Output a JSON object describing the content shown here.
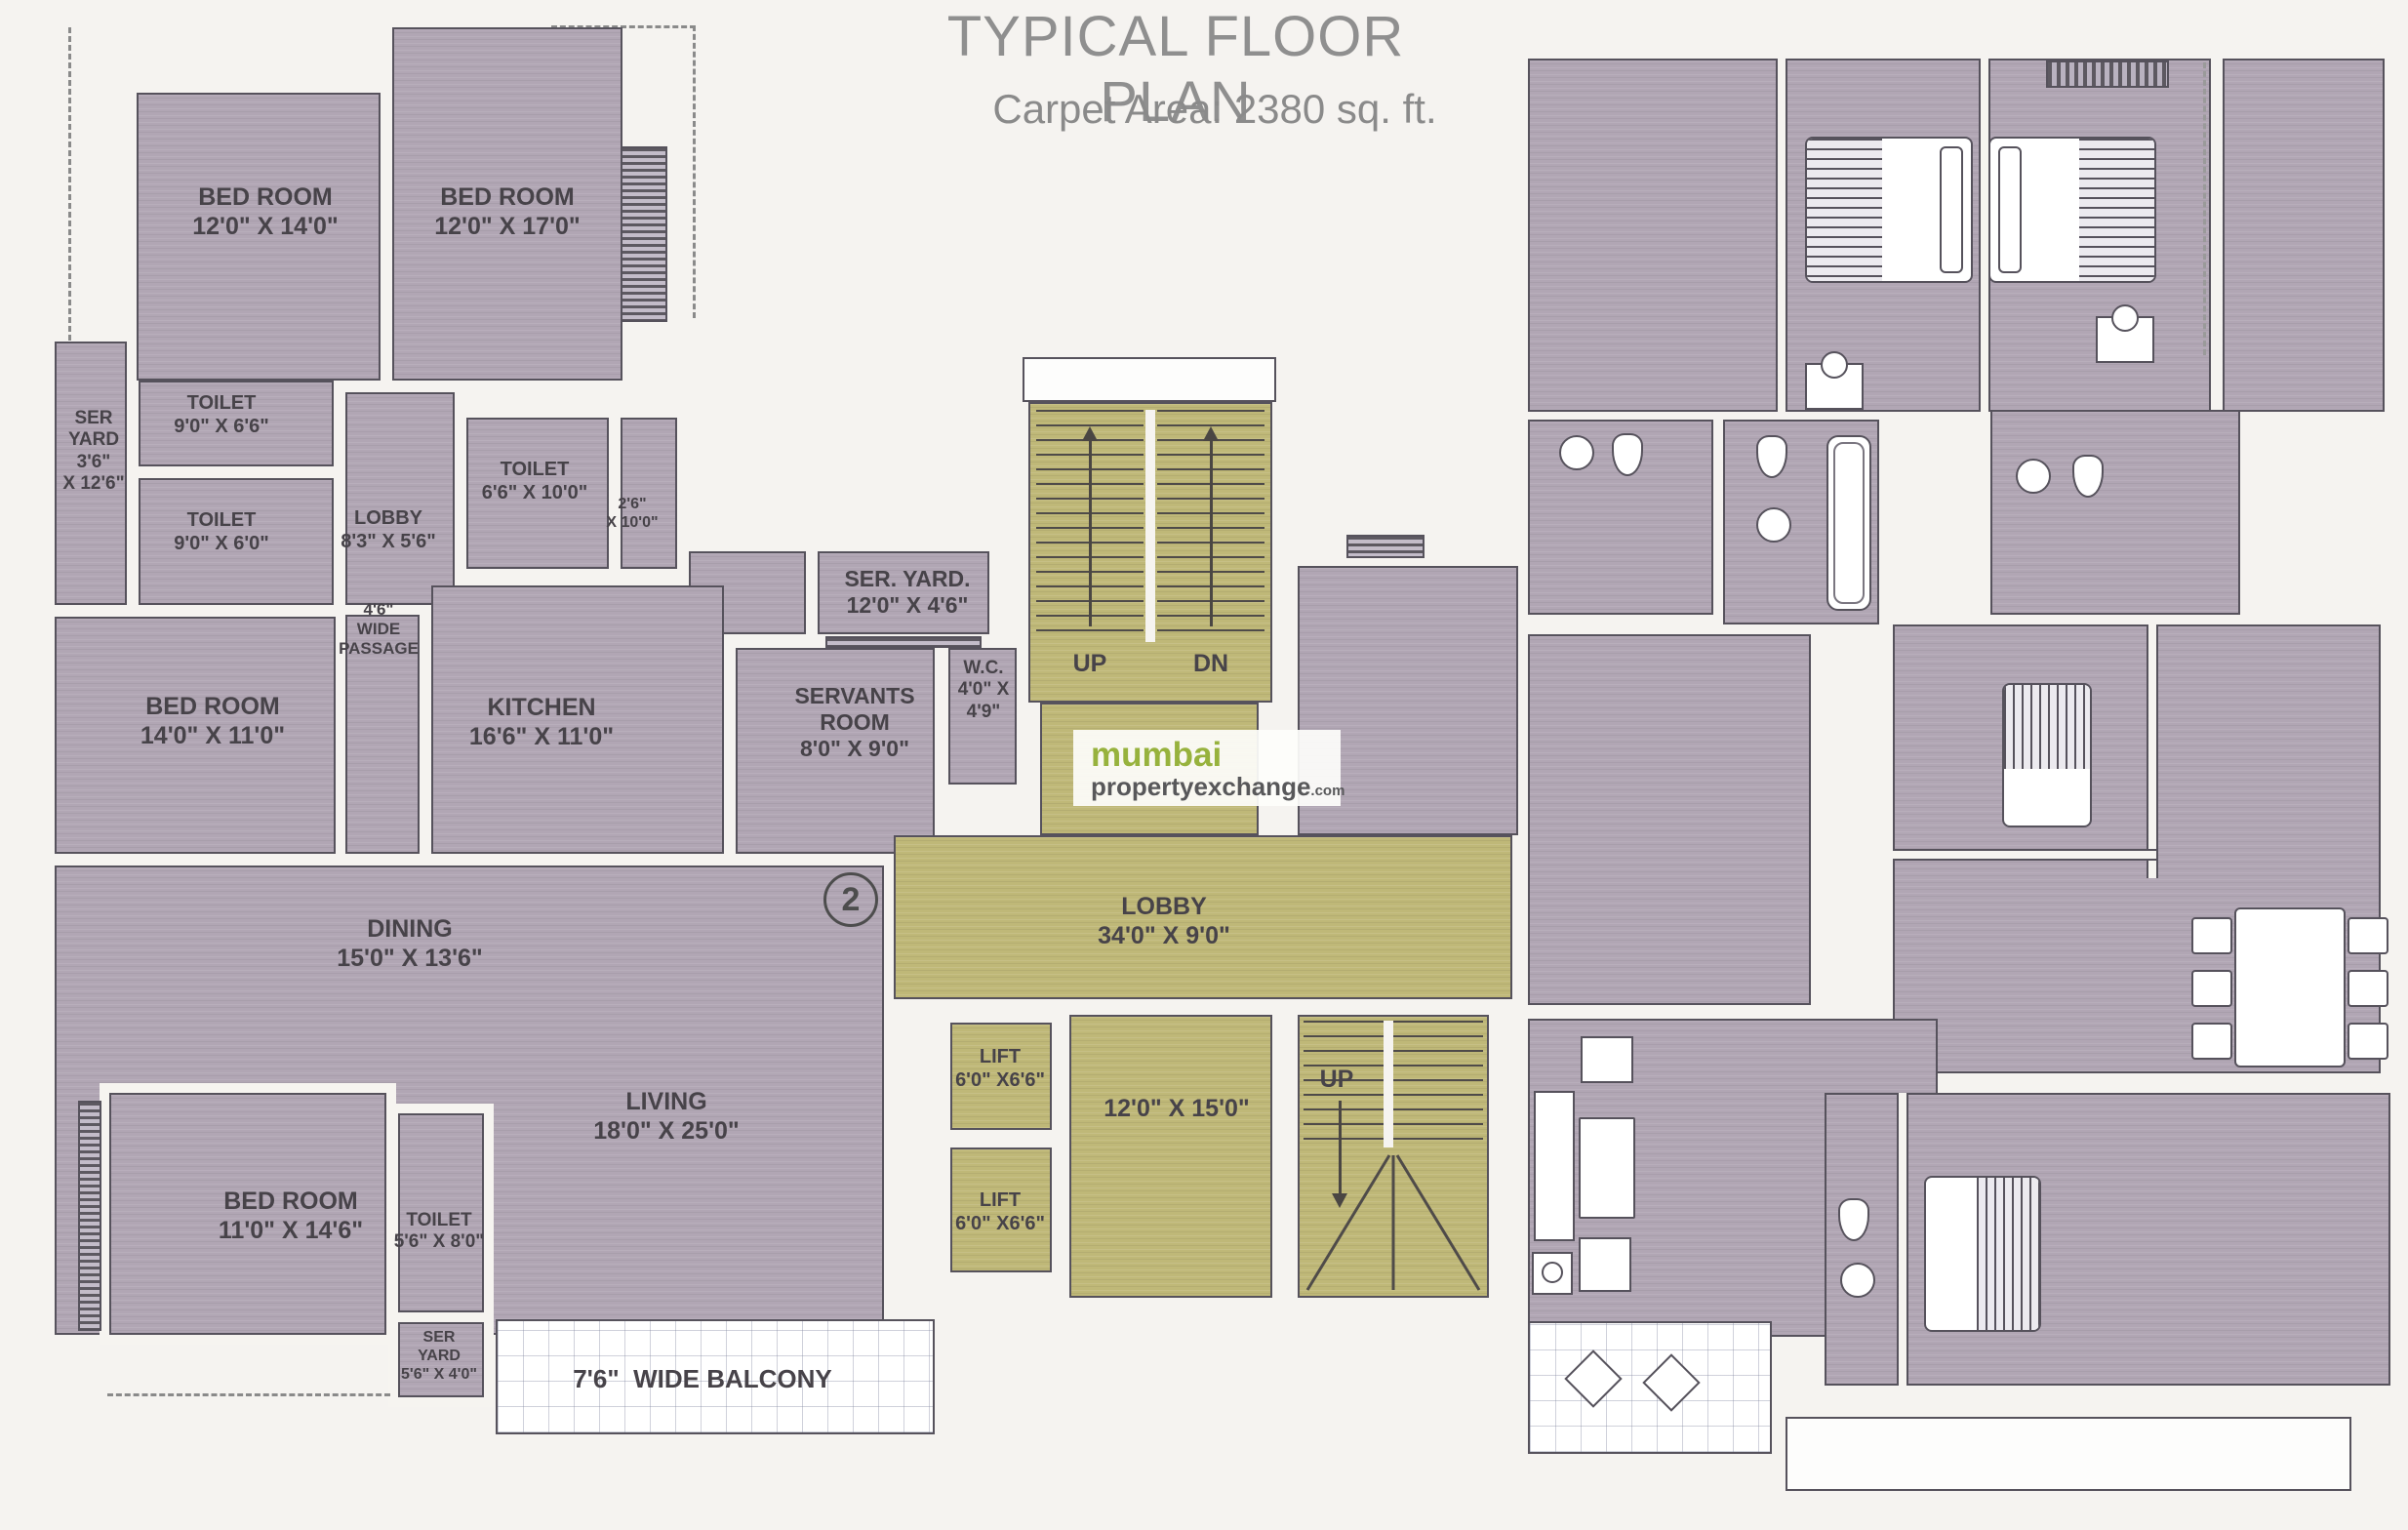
{
  "header": {
    "title": "TYPICAL FLOOR PLAN",
    "subtitle": "Carpet Area: 2380 sq. ft."
  },
  "logo": {
    "top": "mumbai",
    "bottom": "propertyexchange",
    "tld": ".com"
  },
  "units": {
    "unit1": "1",
    "unit2": "2"
  },
  "stairs": {
    "up": "UP",
    "dn": "DN",
    "up2": "UP"
  },
  "rooms": {
    "bedroom_tl1": {
      "name": "BED ROOM",
      "dims": "12'0\" X 14'0\""
    },
    "bedroom_tl2": {
      "name": "BED ROOM",
      "dims": "12'0\" X 17'0\""
    },
    "toilet_a": {
      "name": "TOILET",
      "dims": "9'0\" X 6'6\""
    },
    "ser_yard_left": {
      "l1": "SER",
      "l2": "YARD",
      "l3": "3'6\"",
      "l4": "X 12'6\""
    },
    "toilet_b": {
      "name": "TOILET",
      "dims": "9'0\" X 6'0\""
    },
    "lobby_small": {
      "name": "LOBBY",
      "dims": "8'3\" X 5'6\""
    },
    "toilet_c": {
      "name": "TOILET",
      "dims": "6'6\" X 10'0\""
    },
    "niche": {
      "l1": "2'6\"",
      "l2": "X 10'0\""
    },
    "passage": {
      "l1": "4'6\"",
      "l2": "WIDE",
      "l3": "PASSAGE"
    },
    "bedroom_mid": {
      "name": "BED ROOM",
      "dims": "14'0\" X 11'0\""
    },
    "kitchen": {
      "name": "KITCHEN",
      "dims": "16'6\" X 11'0\""
    },
    "ser_yard_top": {
      "name": "SER. YARD.",
      "dims": "12'0\" X 4'6\""
    },
    "servants": {
      "l1": "SERVANTS",
      "l2": "ROOM",
      "dims": "8'0\" X 9'0\""
    },
    "wc": {
      "l1": "W.C.",
      "l2": "4'0\" X",
      "l3": "4'9\""
    },
    "dining": {
      "name": "DINING",
      "dims": "15'0\" X 13'6\""
    },
    "living": {
      "name": "LIVING",
      "dims": "18'0\" X 25'0\""
    },
    "main_lobby": {
      "name": "LOBBY",
      "dims": "34'0\" X 9'0\""
    },
    "lift1": {
      "name": "LIFT",
      "dims": "6'0\" X6'6\""
    },
    "lift2": {
      "name": "LIFT",
      "dims": "6'0\" X6'6\""
    },
    "stair_hall": {
      "dims": "12'0\" X 15'0\""
    },
    "bedroom_bl": {
      "name": "BED ROOM",
      "dims": "11'0\" X 14'6\""
    },
    "toilet_d": {
      "name": "TOILET",
      "dims": "5'6\" X 8'0\""
    },
    "ser_yard_bottom": {
      "l1": "SER",
      "l2": "YARD",
      "l3": "5'6\" X 4'0\""
    },
    "balcony": {
      "name": "7'6\"  WIDE BALCONY"
    }
  },
  "colors": {
    "room_fill": "#b1a6b4",
    "hall_fill": "#bfb878",
    "wall_line": "#56525c",
    "logo_orange": "#ee7f22",
    "logo_green": "#97b23d",
    "logo_gray": "#58585a"
  }
}
